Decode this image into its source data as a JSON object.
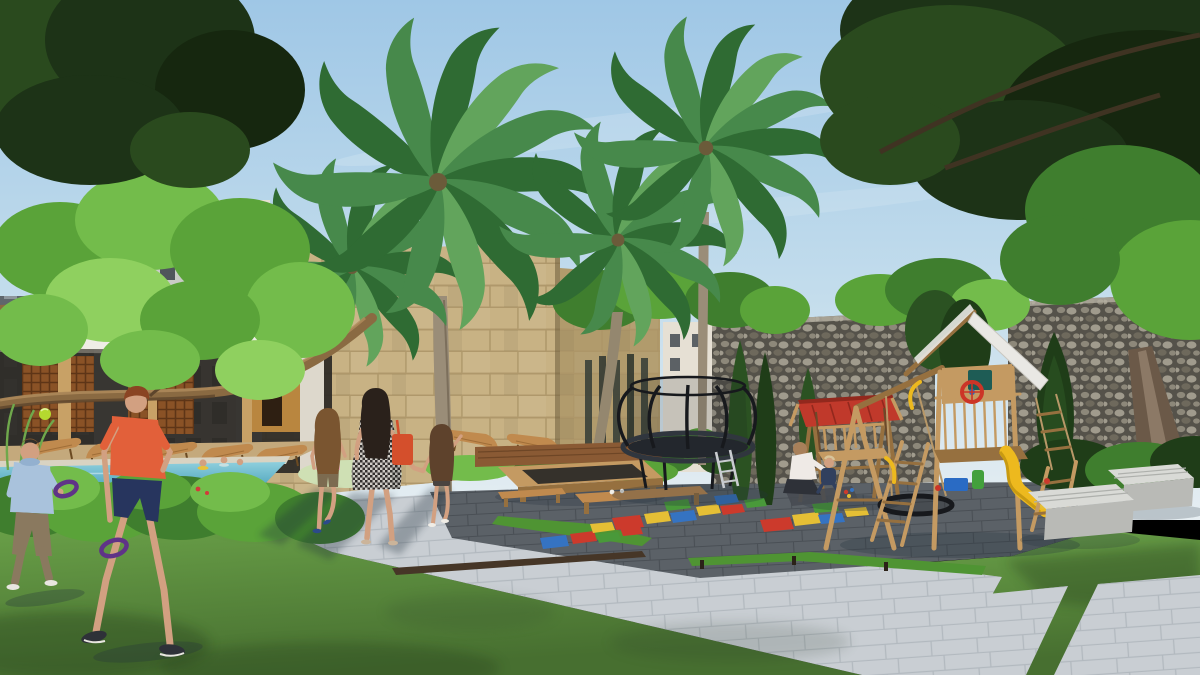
{
  "scene": {
    "type": "architectural-exterior-render",
    "objects": [
      "sky",
      "clouds",
      "apartment-buildings",
      "pool-pavilion",
      "lounge-chairs",
      "swimming-pool",
      "pool-kids",
      "limestone-block-wall",
      "pebble-stone-wall-left",
      "pebble-stone-wall-right",
      "gap-building",
      "palm-trees",
      "big-tree-left-canopy",
      "big-tree-right-canopy",
      "bright-tree",
      "tree-branch",
      "tree-trunk-right",
      "cypress-trees",
      "hedge",
      "shrubs",
      "flowers",
      "lawn",
      "paver-path",
      "paver-pads",
      "dark-playground-pavement",
      "turf-strips",
      "timber-edge-beam",
      "hopscotch-near",
      "hopscotch-far",
      "trampoline",
      "trampoline-ladder",
      "daybed-frame",
      "wood-deck",
      "low-table",
      "low-bench",
      "canopy-swing-bench",
      "sitting-mother",
      "toddler",
      "play-mat",
      "wooden-playset",
      "playset-roof",
      "playset-slide",
      "steering-wheel",
      "nest-swing",
      "climbing-ramp",
      "rope-ladder",
      "toy-box",
      "concrete-benches",
      "walking-woman",
      "shoulder-bag",
      "girl-pink-top",
      "little-girl",
      "boy-blue-hoodie",
      "boy-orange-shirt",
      "purple-ring-paddles",
      "green-ball"
    ]
  },
  "palette": {
    "sky_top": "#9fc7e6",
    "sky_mid": "#c2dcec",
    "sky_low": "#e6eef2",
    "cloud": "#ffffff",
    "canopy_dark1": "#1d3317",
    "canopy_dark2": "#2a4a1e",
    "canopy_dark3": "#16270f",
    "leaf_bright1": "#5aa339",
    "leaf_bright2": "#73bc4b",
    "leaf_bright3": "#8fd05f",
    "leaf_mid": "#3f7e2e",
    "palm_dark": "#2f6b33",
    "palm_mid": "#47894b",
    "palm_light": "#62a45c",
    "branch_wood": "#8a6a42",
    "branch_dark": "#5d452c",
    "building_light": "#c9cbc7",
    "building_dark": "#5f666c",
    "building_white": "#e6e0d4",
    "window_dark": "#3a4148",
    "wall_beige": "#c8b284",
    "wall_beige_dark": "#b19b6c",
    "mortar_beige": "#ab9466",
    "pebble_light": "#a09b8d",
    "pebble_mid": "#8d887a",
    "pebble_dark": "#6e695c",
    "mortar_grey": "#55524a",
    "cypress": "#2b5222",
    "cypress_dark": "#1f3d18",
    "pool_deep": "#3e9ab5",
    "pool_light": "#8ecfdd",
    "coping": "#d9d3c2",
    "roof_white": "#efede6",
    "pavilion_dark": "#2e2b26",
    "lattice": "#8a5226",
    "lattice_dark": "#5e3517",
    "column_wood": "#c8a166",
    "lounger": "#c08a4e",
    "deck_wood": "#8a5a34",
    "deck_tan": "#c4a97c",
    "grass": "#5d9140",
    "grass_dark": "#476f30",
    "grass_light": "#6fa84c",
    "turf": "#4f9433",
    "paver": "#c9ced3",
    "paver_line": "#aab1b8",
    "pave_dark": "#5b6167",
    "pave_dark_line": "#474c52",
    "edge_beam": "#463627",
    "tramp": "#23272d",
    "tramp_frame": "#30363e",
    "tramp_pole": "#17191d",
    "wood_play": "#c49a62",
    "wood_play_dark": "#96703f",
    "roof_panel": "#e9e8e4",
    "slide_yellow": "#edb91e",
    "window_teal": "#1e5c55",
    "wheel_red": "#cc3527",
    "toy_blue": "#2a6bc4",
    "toy_green": "#43a03c",
    "canopy_red": "#c0392b",
    "canopy_red_dark": "#92281d",
    "bench_concrete": "#d9dad6",
    "bench_concrete_side": "#b9bab6",
    "skin": "#d2a081",
    "hair_dark": "#2a211b",
    "hair_brown": "#7a5530",
    "hair_auburn": "#8a4423",
    "hair_light": "#a8805a",
    "shirt_orange": "#e2603a",
    "shorts_navy": "#27355e",
    "hoodie_blue": "#a9c2dc",
    "pants_khaki": "#8a795f",
    "dress_dark": "#33302e",
    "dress_light": "#cfccc6",
    "bag_red": "#d44f2c",
    "top_pink": "#e9aab6",
    "top_white": "#efeae6",
    "ring_purple": "#5f3387",
    "ball_green": "#b5d92f",
    "hs_red": "#cc3a2c",
    "hs_yellow": "#e5bf35",
    "hs_blue": "#3573c2",
    "hs_green": "#49993a",
    "shadow": "#24313c"
  }
}
